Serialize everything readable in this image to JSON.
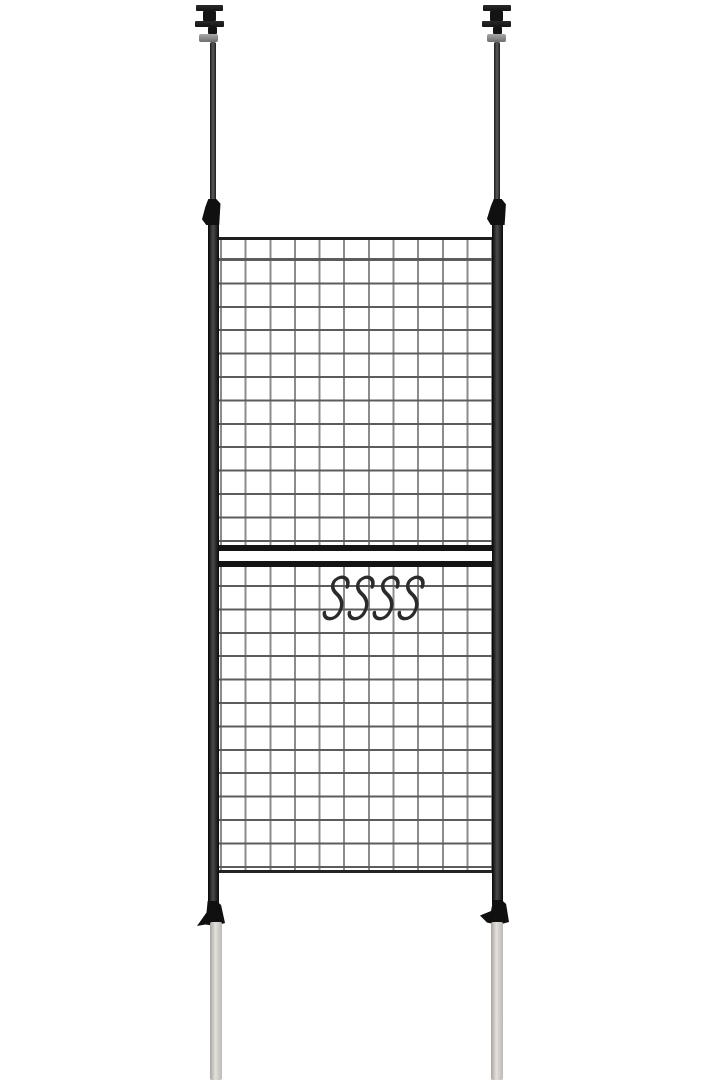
{
  "scene": {
    "type": "product-photo",
    "subject": "Floor-to-ceiling tension pole wire grid partition panel with hanging S-hooks on a plain white background",
    "background_color": "#ffffff",
    "colors": {
      "bg": "#ffffff",
      "frame": "#141414",
      "pole_highlight": "#4a4a4a",
      "mesh_h": "#5c5c5c",
      "mesh_v": "#8c8c8c",
      "collar_light": "#a8a8a8",
      "collar_dark": "#6e6e6e",
      "floor_pole_light": "#e3e1dd",
      "floor_pole_shade": "#aaa49e",
      "hook": "#2b2b2b"
    },
    "structure": {
      "tension_poles": 2,
      "ceiling_mounts": 2,
      "grid_panels": 2,
      "grid_rows_per_panel": 13,
      "grid_columns": 11,
      "s_hooks": 4,
      "adjustment_clamps": 4
    }
  }
}
